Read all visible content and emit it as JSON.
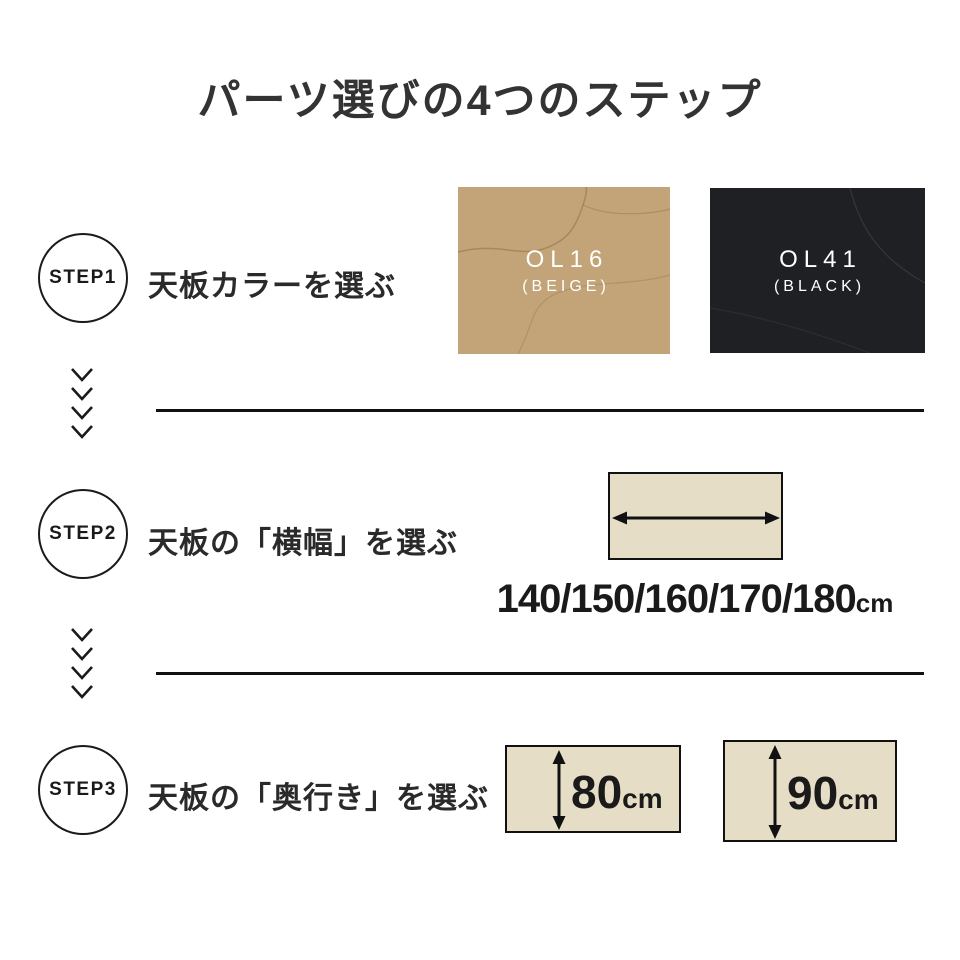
{
  "page": {
    "title": "パーツ選びの4つのステップ"
  },
  "colors": {
    "text": "#333333",
    "line": "#111111",
    "panel_fill": "#e6ddc7",
    "swatch_text": "#ffffff"
  },
  "steps": [
    {
      "badge": "STEP1",
      "label": "天板カラーを選ぶ",
      "swatches": [
        {
          "code": "OL16",
          "name": "(BEIGE)",
          "color": "#c2a478"
        },
        {
          "code": "OL41",
          "name": "(BLACK)",
          "color": "#1e2024"
        }
      ]
    },
    {
      "badge": "STEP2",
      "label": "天板の「横幅」を選ぶ",
      "widths": "140/150/160/170/180",
      "unit": "cm"
    },
    {
      "badge": "STEP3",
      "label": "天板の「奥行き」を選ぶ",
      "depths": [
        {
          "value": "80",
          "unit": "cm"
        },
        {
          "value": "90",
          "unit": "cm"
        }
      ]
    }
  ]
}
